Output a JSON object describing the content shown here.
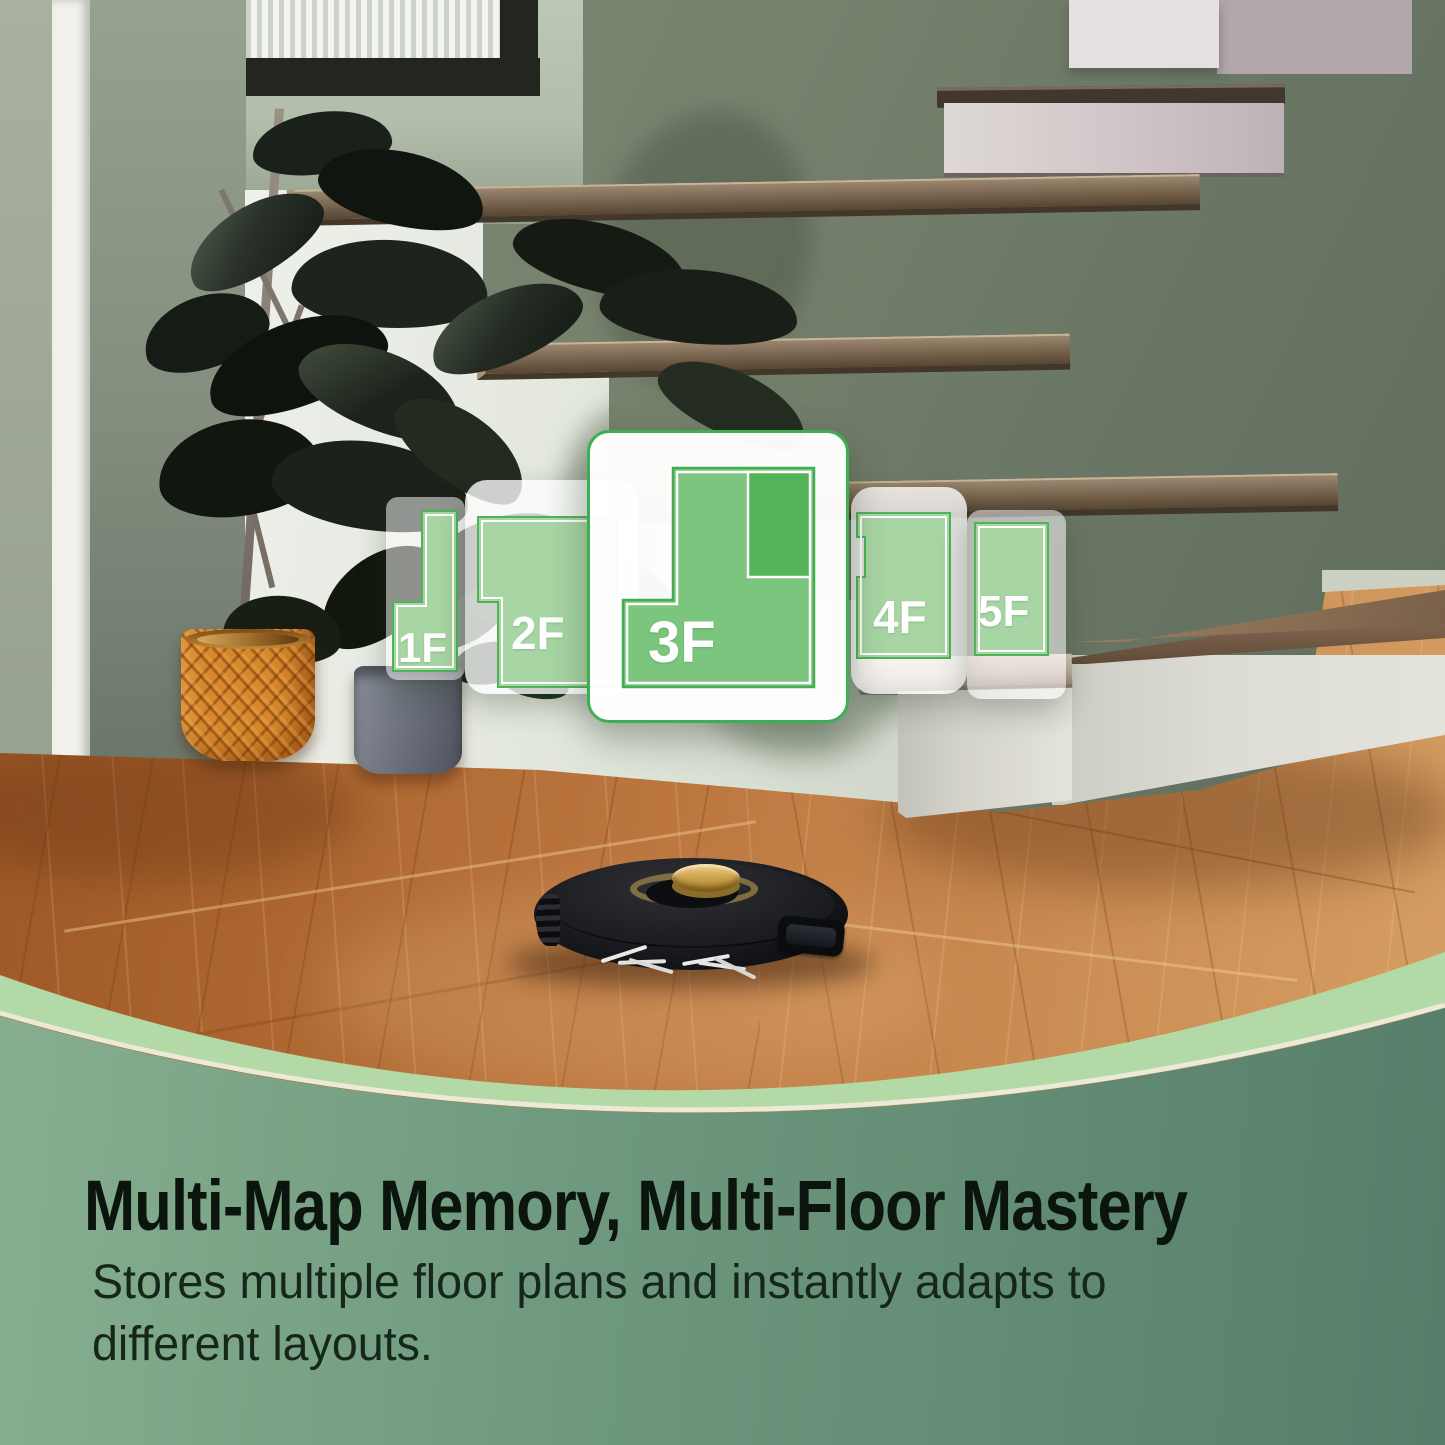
{
  "floor_selector": {
    "cards": [
      {
        "label": "1F",
        "selected": false
      },
      {
        "label": "2F",
        "selected": false
      },
      {
        "label": "3F",
        "selected": true
      },
      {
        "label": "4F",
        "selected": false
      },
      {
        "label": "5F",
        "selected": false
      }
    ]
  },
  "caption": {
    "headline": "Multi-Map Memory, Multi-Floor Mastery",
    "subtitle_line1": "Stores multiple floor plans and instantly adapts to",
    "subtitle_line2": "different layouts."
  },
  "colors": {
    "accent_green": "#3fae53",
    "plan_green_light": "#a8d5a4",
    "plan_green_mid": "#7cc57e",
    "plan_green_dark": "#54b457",
    "band_light_green": "#b3d9a6",
    "band_cream_line": "#ece9d6",
    "panel_green_left": "#83ab8d",
    "panel_green_right": "#577e6a",
    "headline_text": "#0b150e"
  }
}
